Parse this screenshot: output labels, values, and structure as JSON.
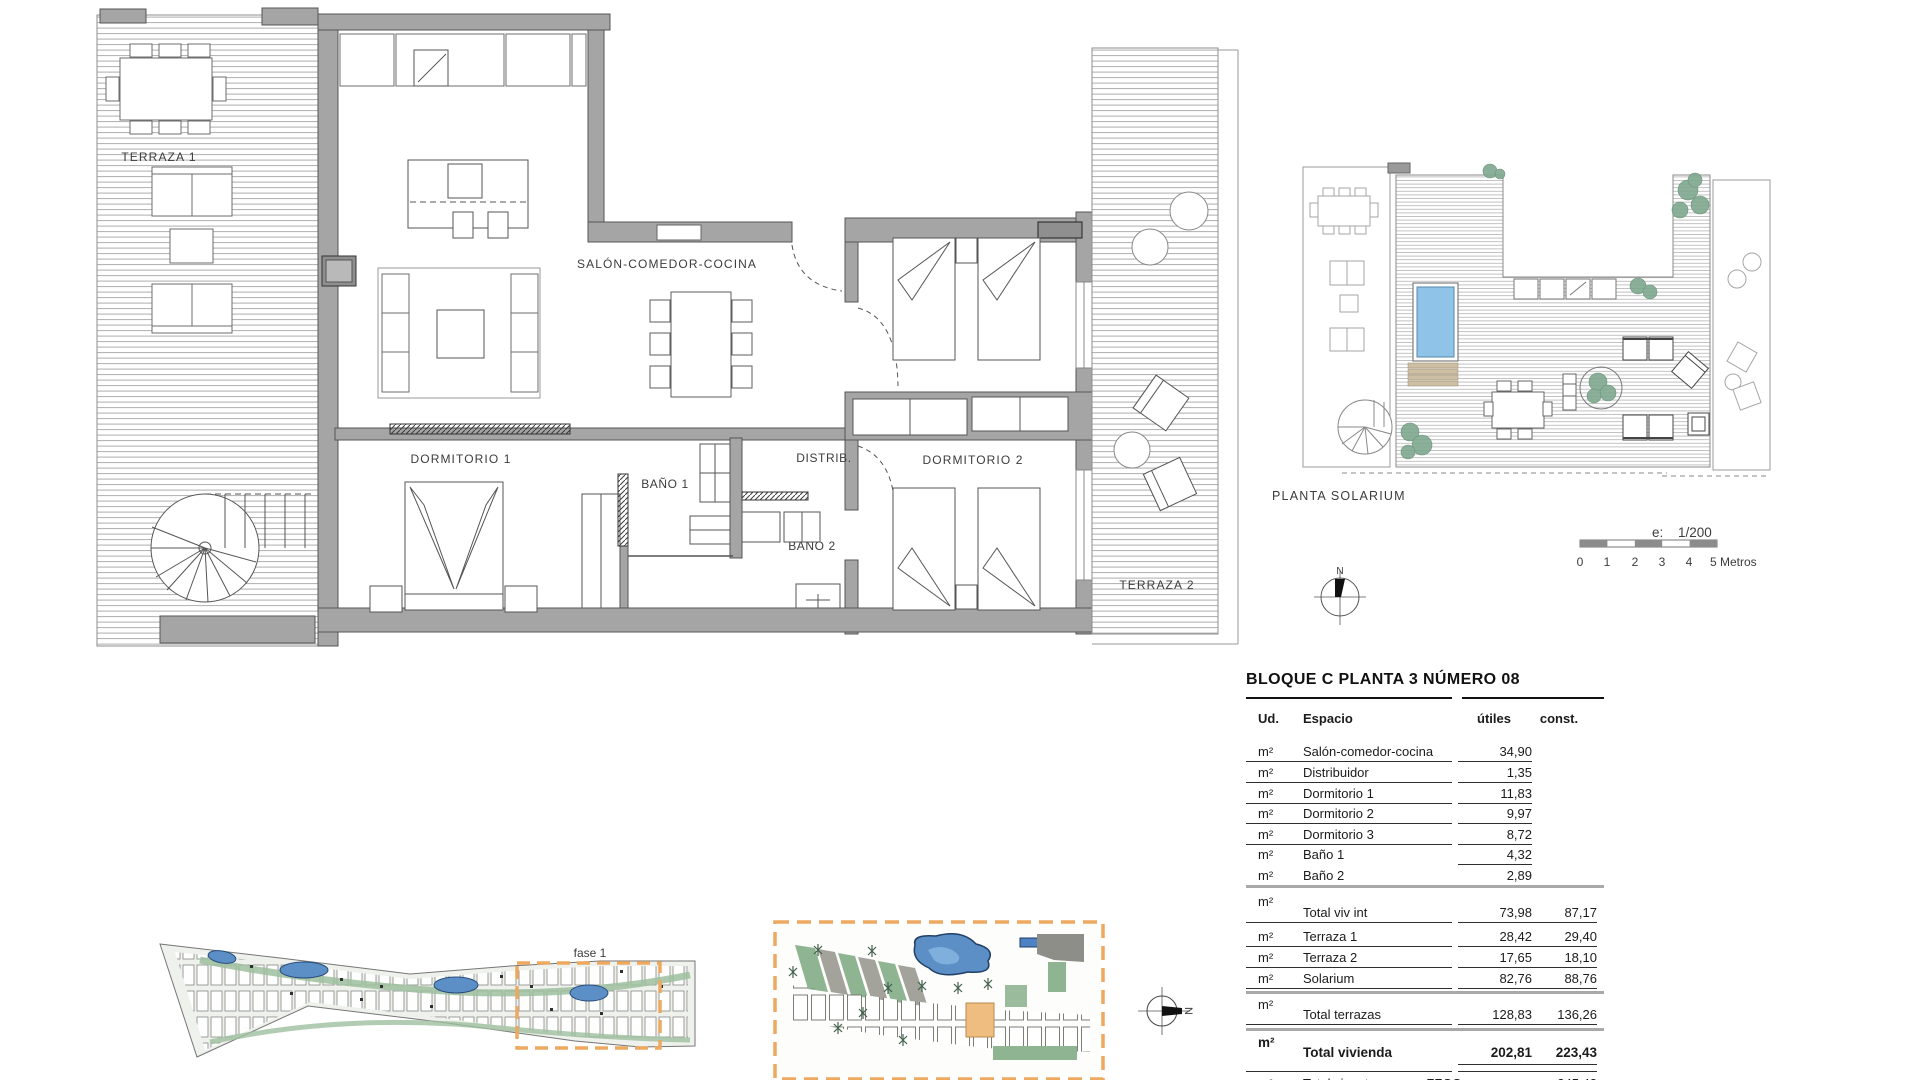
{
  "plan": {
    "terraza1": "TERRAZA 1",
    "salon": "SALÓN-COMEDOR-COCINA",
    "dormitorio1": "DORMITORIO 1",
    "bano1": "BAÑO 1",
    "distrib": "DISTRIB.",
    "bano2": "BAÑO 2",
    "dormitorio2": "DORMITORIO 2",
    "terraza2": "TERRAZA 2"
  },
  "solarium": {
    "title": "PLANTA SOLARIUM",
    "scale_prefix": "e:",
    "scale_ratio": "1/200",
    "ticks": [
      "0",
      "1",
      "2",
      "3",
      "4"
    ],
    "scale_end": "5 Metros",
    "compass_n": "N"
  },
  "site": {
    "fase": "fase 1",
    "compass_n": "N"
  },
  "table": {
    "title": "BLOQUE C  PLANTA 3  NÚMERO 08",
    "unit": "m²",
    "headers": {
      "ud": "Ud.",
      "espacio": "Espacio",
      "utiles": "útiles",
      "const": "const."
    },
    "rows": [
      {
        "espacio": "Salón-comedor-cocina",
        "utiles": "34,90"
      },
      {
        "espacio": "Distribuidor",
        "utiles": "1,35"
      },
      {
        "espacio": "Dormitorio 1",
        "utiles": "11,83"
      },
      {
        "espacio": "Dormitorio 2",
        "utiles": "9,97"
      },
      {
        "espacio": "Dormitorio 3",
        "utiles": "8,72"
      },
      {
        "espacio": "Baño 1",
        "utiles": "4,32"
      },
      {
        "espacio": "Baño 2",
        "utiles": "2,89"
      }
    ],
    "totals": [
      {
        "espacio": "Total viv int",
        "utiles": "73,98",
        "const": "87,17"
      },
      {
        "espacio": "Terraza 1",
        "utiles": "28,42",
        "const": "29,40"
      },
      {
        "espacio": "Terraza 2",
        "utiles": "17,65",
        "const": "18,10"
      },
      {
        "espacio": "Solarium",
        "utiles": "82,76",
        "const": "88,76"
      },
      {
        "espacio": "Total terrazas",
        "utiles": "128,83",
        "const": "136,26"
      },
      {
        "espacio": "Total vivienda",
        "utiles": "202,81",
        "const": "223,43"
      }
    ],
    "partial": {
      "espacio": "Total viv + terrazas + ZZCC",
      "const": "245,43"
    }
  },
  "colors": {
    "wall_gray": "#a5a5a5",
    "pool_blue": "#8fc4e8",
    "site_pool_blue": "#5d8fc7",
    "landscape_green": "#8fb491",
    "phase_orange": "#eca95f",
    "unit_highlight_orange": "#f0bd80"
  }
}
